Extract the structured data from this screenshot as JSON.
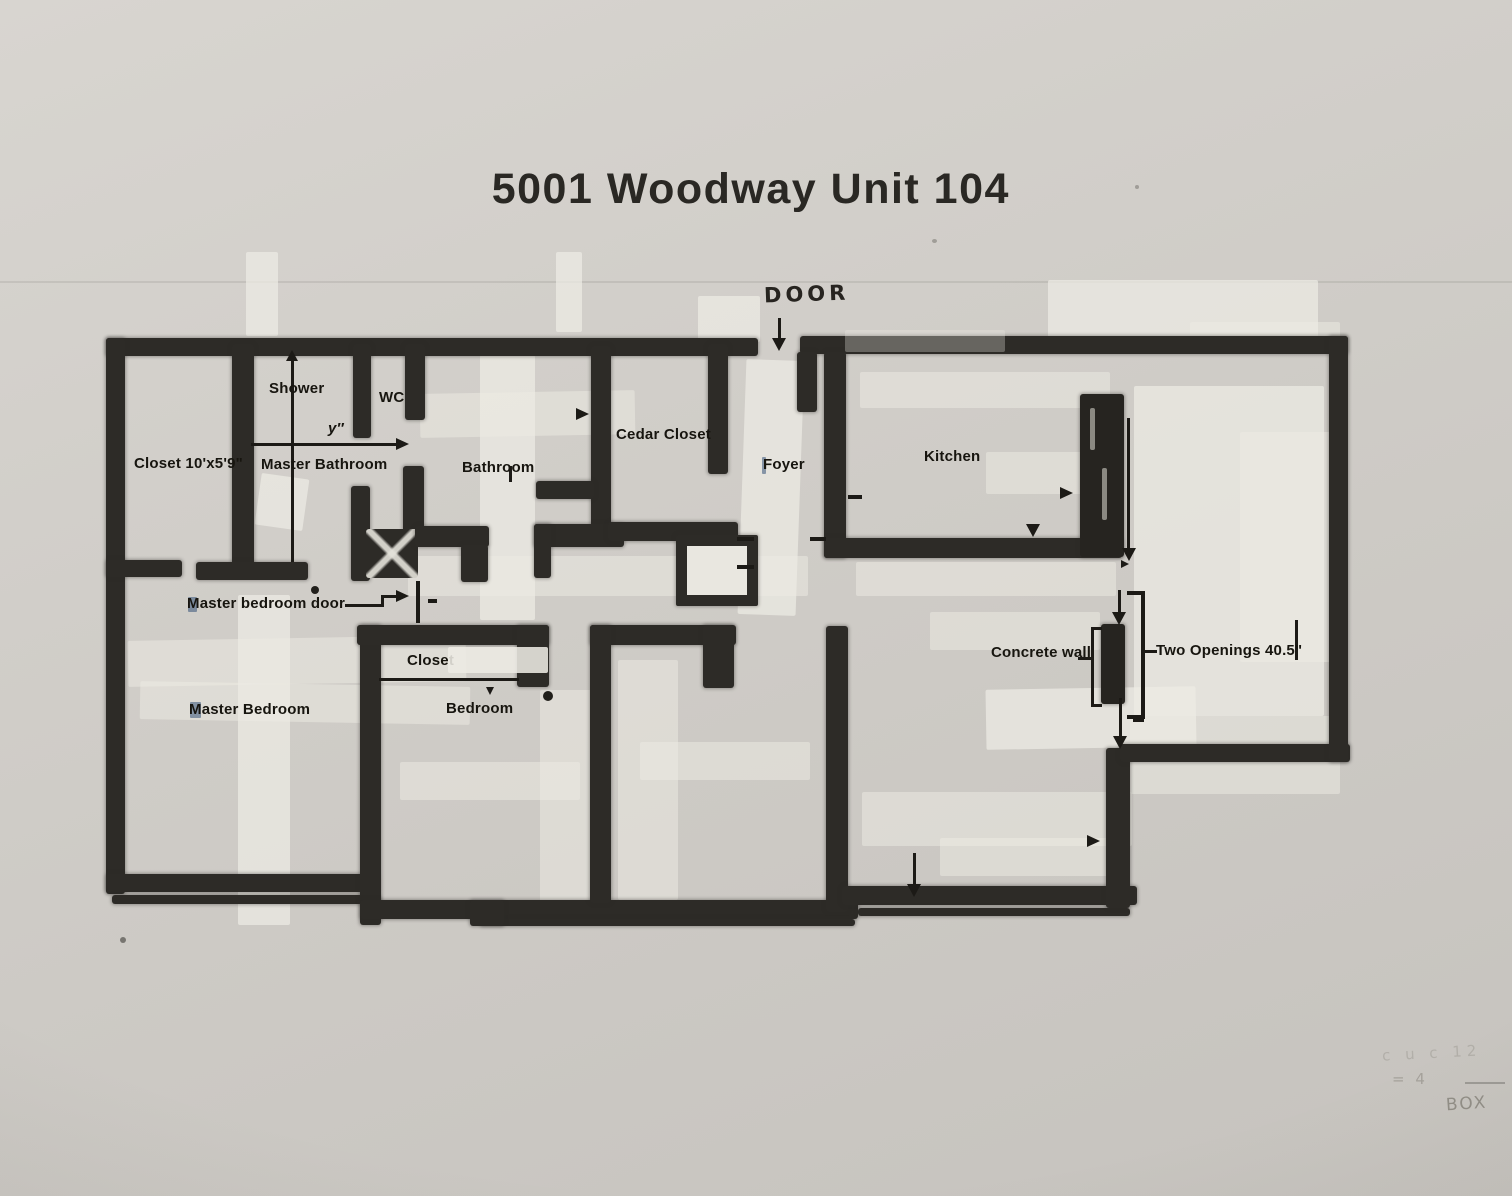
{
  "title": "5001 Woodway Unit 104",
  "rooms": {
    "closet_master": "Closet 10'x5'9\"",
    "shower": "Shower",
    "wc": "WC",
    "master_bathroom": "Master Bathroom",
    "bathroom": "Bathroom",
    "cedar_closet": "Cedar Closet",
    "foyer": "Foyer",
    "kitchen": "Kitchen",
    "master_bedroom": "Master Bedroom",
    "bedroom": "Bedroom",
    "bedroom_closet": "Closet"
  },
  "annotations": {
    "door": "DOOR",
    "master_bedroom_door": "Master bedroom door",
    "concrete_wall": "Concrete wall",
    "two_openings": "Two Openings 40.5\"",
    "dim_y": "y″"
  },
  "pencil_notes": {
    "note1": "c u c 12",
    "note2": "= 4",
    "note3": "BOX"
  },
  "colors": {
    "paper": "#cdcac5",
    "wall": "#2d2b27",
    "ink": "#17150f",
    "tape": "#edebe4",
    "pencil": "#5d594f"
  }
}
